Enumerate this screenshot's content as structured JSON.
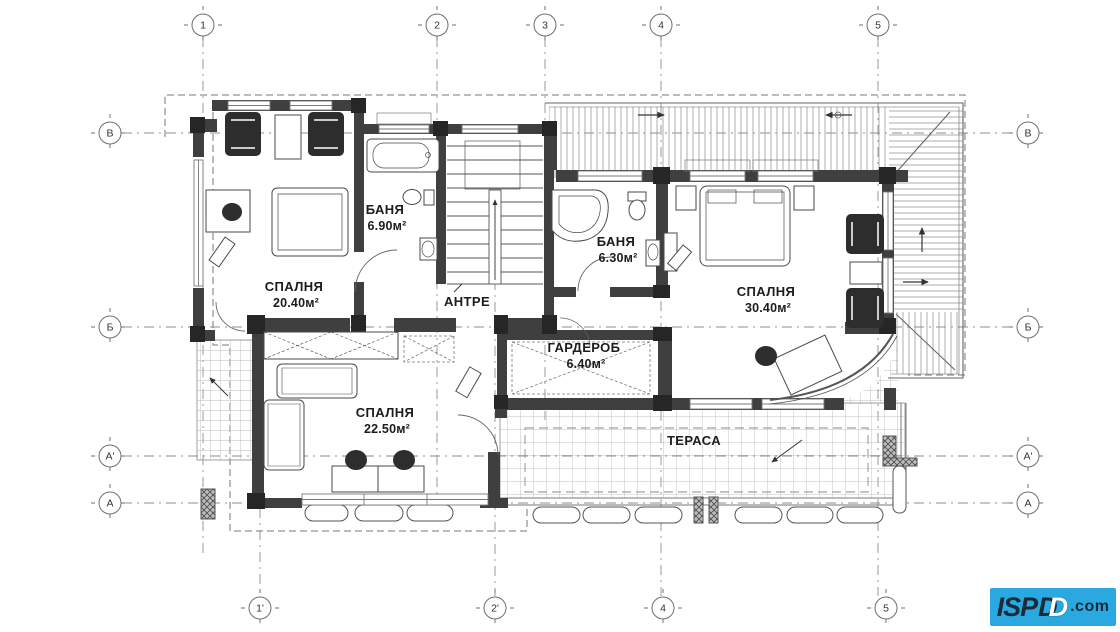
{
  "axes": {
    "top": [
      "1",
      "2",
      "3",
      "4",
      "5"
    ],
    "bottom": [
      "1'",
      "2'",
      "4",
      "5"
    ],
    "left": [
      "В",
      "Б",
      "А'",
      "А"
    ],
    "right": [
      "В",
      "Б",
      "А'",
      "А"
    ]
  },
  "rooms": [
    {
      "name": "СПАЛНЯ",
      "area": "20.40м²"
    },
    {
      "name": "БАНЯ",
      "area": "6.90м²"
    },
    {
      "name": "АНТРЕ",
      "area": ""
    },
    {
      "name": "БАНЯ",
      "area": "6.30м²"
    },
    {
      "name": "СПАЛНЯ",
      "area": "30.40м²"
    },
    {
      "name": "ГАРДЕРОБ",
      "area": "6.40м²"
    },
    {
      "name": "СПАЛНЯ",
      "area": "22.50м²"
    },
    {
      "name": "ТЕРАСА",
      "area": ""
    }
  ],
  "logo": {
    "brand": "ISP",
    "d": "D",
    "d_outline": "D",
    "suffix": ".com",
    "background": "#29a9e0",
    "text_color": "#1b2a38",
    "outline_color": "#ffffff"
  }
}
